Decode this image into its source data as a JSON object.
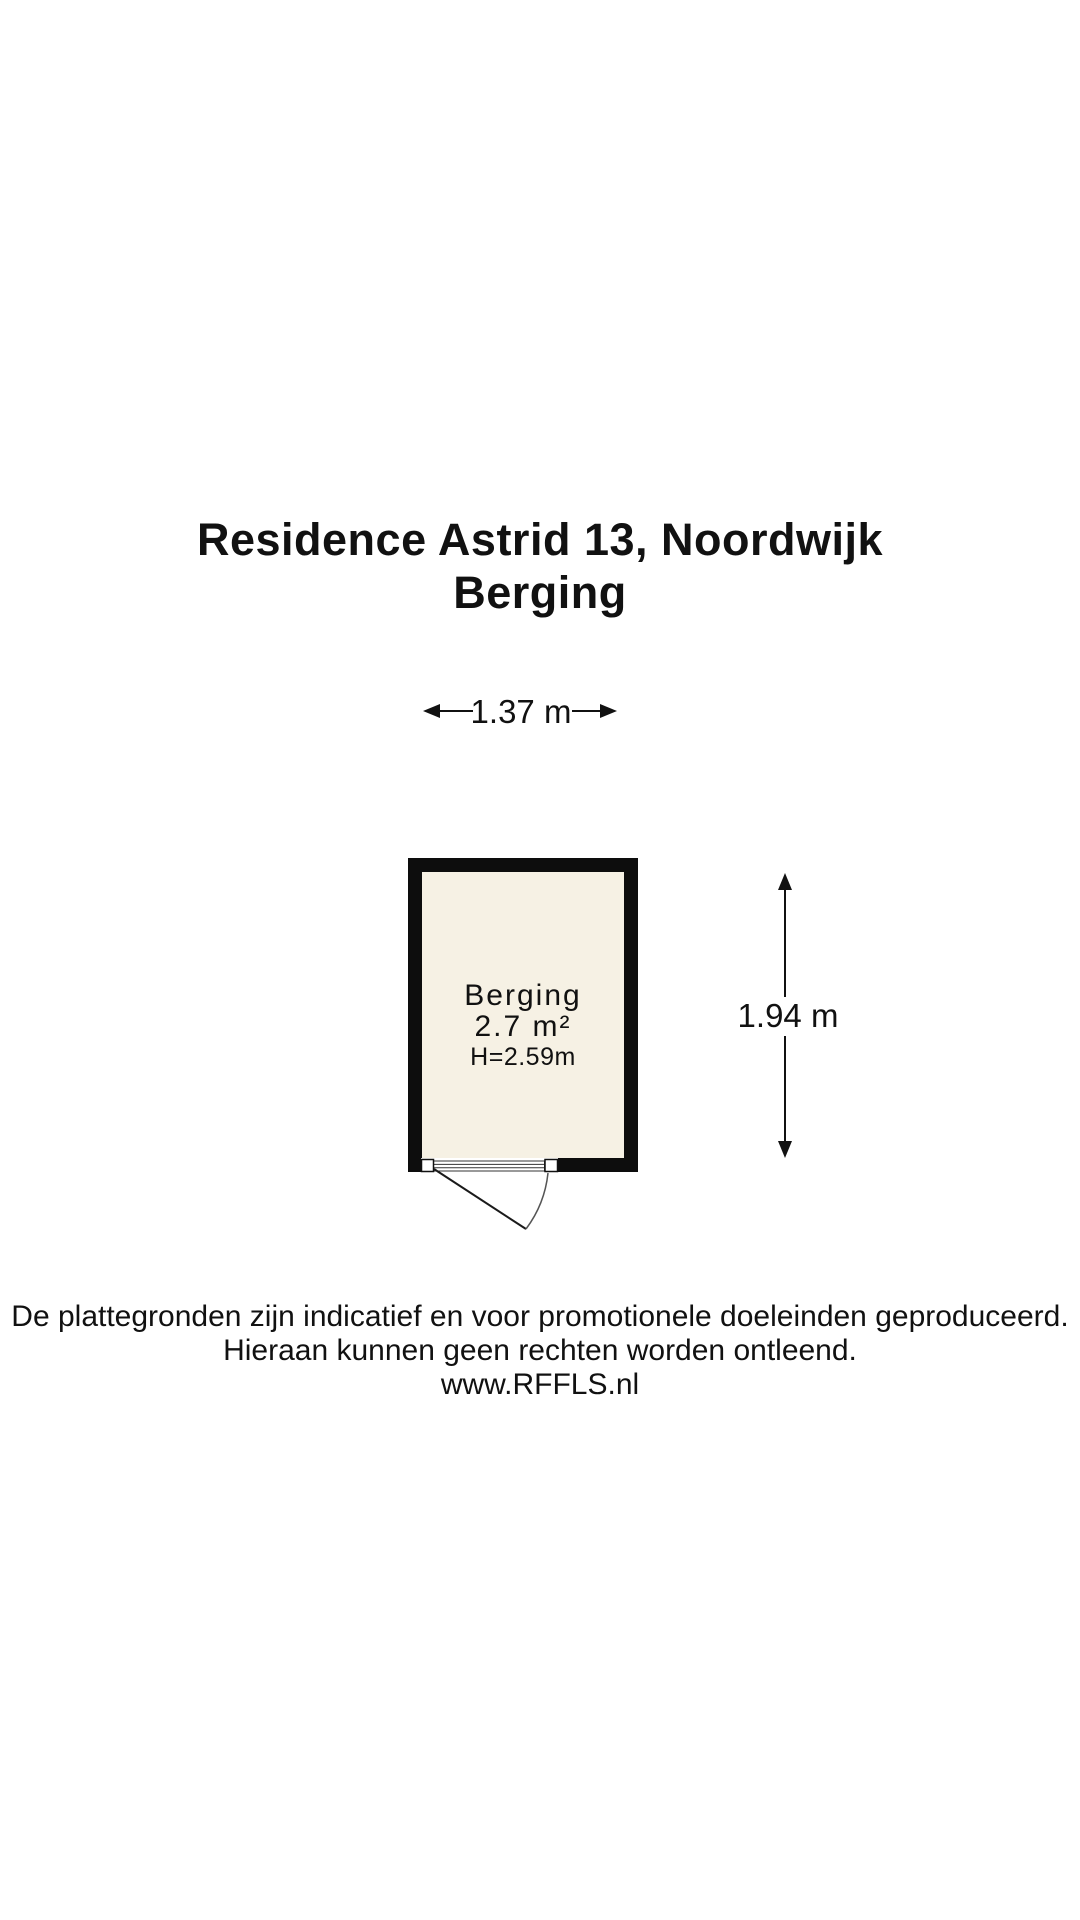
{
  "title": {
    "line1": "Residence Astrid 13, Noordwijk",
    "line2": "Berging"
  },
  "floorplan": {
    "room": {
      "name": "Berging",
      "area": "2.7 m²",
      "ceiling_height": "H=2.59m"
    },
    "dimensions": {
      "width": "1.37 m",
      "height": "1.94 m"
    }
  },
  "footer": {
    "line1": "De plattegronden zijn indicatief en voor promotionele doeleinden geproduceerd.",
    "line2": "Hieraan kunnen geen rechten worden ontleend.",
    "line3": "www.RFFLS.nl"
  },
  "colors": {
    "background": "#ffffff",
    "wall": "#0d0d0d",
    "floor": "#f6f1e4",
    "text": "#111111",
    "line": "#333333"
  }
}
